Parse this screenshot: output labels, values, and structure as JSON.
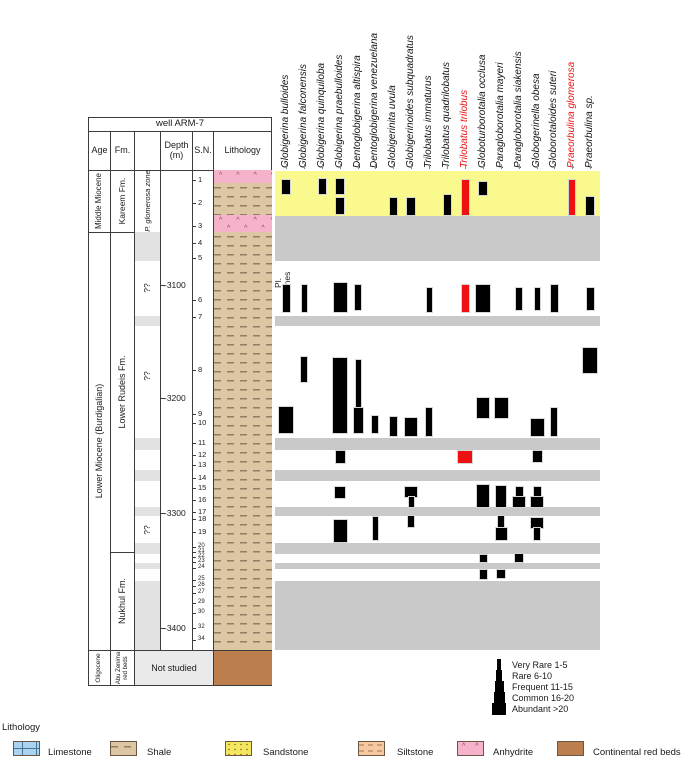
{
  "well_title": "well ARM-7",
  "columns": {
    "age": "Age",
    "fm": "Fm.",
    "zones": "Pl.\nzones",
    "depth": "Depth\n(m)",
    "sn": "S.N.",
    "lithology": "Lithology"
  },
  "ages": {
    "middle_miocene": "Middle Miocene",
    "lower_miocene": "Lower Miocene (Burdigalian)",
    "oligocene": "Oligocene"
  },
  "formations": {
    "kareem": "Kareem Fm.",
    "lower_rudeis": "Lower Rudeis Fm.",
    "nukhul": "Nukhul Fm.",
    "abu_zenima": "Abu Zenima red beds"
  },
  "zones": {
    "named_zone": "P. glomerosa zone",
    "unknown": "??",
    "unknown_y": [
      288,
      376,
      530
    ],
    "gray_blocks_y": [
      [
        232,
        261
      ],
      [
        316,
        326
      ],
      [
        438,
        450
      ],
      [
        470,
        481
      ],
      [
        507,
        516
      ],
      [
        543,
        554
      ],
      [
        563,
        569
      ],
      [
        581,
        650
      ]
    ]
  },
  "not_studied_label": "Not studied",
  "depth_ticks": [
    {
      "label": "-3100",
      "y": 285
    },
    {
      "label": "-3200",
      "y": 398
    },
    {
      "label": "-3300",
      "y": 513
    },
    {
      "label": "-3400",
      "y": 628
    }
  ],
  "samples": [
    {
      "n": 1,
      "y": 180
    },
    {
      "n": 2,
      "y": 203
    },
    {
      "n": 3,
      "y": 226
    },
    {
      "n": 4,
      "y": 243
    },
    {
      "n": 5,
      "y": 258
    },
    {
      "n": 6,
      "y": 300
    },
    {
      "n": 7,
      "y": 317
    },
    {
      "n": 8,
      "y": 370
    },
    {
      "n": 9,
      "y": 414
    },
    {
      "n": 10,
      "y": 423
    },
    {
      "n": 11,
      "y": 443
    },
    {
      "n": 12,
      "y": 455
    },
    {
      "n": 13,
      "y": 465
    },
    {
      "n": 14,
      "y": 478
    },
    {
      "n": 15,
      "y": 488
    },
    {
      "n": 16,
      "y": 500
    },
    {
      "n": 17,
      "y": 512
    },
    {
      "n": 18,
      "y": 519
    },
    {
      "n": 19,
      "y": 532
    },
    {
      "n": 20,
      "y": 547
    },
    {
      "n": 21,
      "y": 552
    },
    {
      "n": 22,
      "y": 557
    },
    {
      "n": 23,
      "y": 562
    },
    {
      "n": 24,
      "y": 568
    },
    {
      "n": 25,
      "y": 580
    },
    {
      "n": 26,
      "y": 586
    },
    {
      "n": 27,
      "y": 593
    },
    {
      "n": 29,
      "y": 603
    },
    {
      "n": 30,
      "y": 613
    },
    {
      "n": 32,
      "y": 628
    },
    {
      "n": 34,
      "y": 640
    }
  ],
  "chart_data": {
    "type": "bar",
    "subtype": "biostratigraphic-range-chart",
    "ylabel": "Depth (m)",
    "species": [
      {
        "name": "Globigerina bulloides",
        "red": false
      },
      {
        "name": "Globigerina falconensis",
        "red": false
      },
      {
        "name": "Globigerina quinquiloba",
        "red": false
      },
      {
        "name": "Globigerina praebulloides",
        "red": false
      },
      {
        "name": "Dentoglobigerina altispira",
        "red": false
      },
      {
        "name": "Dentoglobigerina venezuelana",
        "red": false
      },
      {
        "name": "Globigerinita uvula",
        "red": false
      },
      {
        "name": "Globigerinoides subquadratus",
        "red": false
      },
      {
        "name": "Trilobatus immaturus",
        "red": false
      },
      {
        "name": "Trilobatus quadrilobatus",
        "red": false
      },
      {
        "name": "Trilobatus trilobus",
        "red": true
      },
      {
        "name": "Globoturborotalia occlusa",
        "red": false
      },
      {
        "name": "Paragloborotalia mayeri",
        "red": false
      },
      {
        "name": "Paragloborotalia siakensis",
        "red": false
      },
      {
        "name": "Globogerinella obesa",
        "red": false
      },
      {
        "name": "Globorotaloides suteri",
        "red": false
      },
      {
        "name": "Praeorbulina glomerosa",
        "red": true
      },
      {
        "name": "Praeorbulina sp.",
        "red": false
      }
    ],
    "col_centers": [
      286,
      304,
      322,
      340,
      358,
      375,
      393,
      411,
      429,
      447,
      465,
      483,
      501,
      519,
      537,
      554,
      572,
      590
    ],
    "yellow_band_y": [
      171,
      216
    ],
    "gray_bands_y": [
      [
        216,
        261
      ],
      [
        316,
        326
      ],
      [
        438,
        450
      ],
      [
        470,
        481
      ],
      [
        507,
        516
      ],
      [
        543,
        554
      ],
      [
        563,
        569
      ],
      [
        581,
        650
      ]
    ],
    "bars": [
      {
        "s": 1,
        "y1": 180,
        "y2": 194,
        "w": 8,
        "c": "k"
      },
      {
        "s": 3,
        "y1": 179,
        "y2": 194,
        "w": 7,
        "c": "k"
      },
      {
        "s": 4,
        "y1": 179,
        "y2": 194,
        "w": 8,
        "c": "k"
      },
      {
        "s": 4,
        "y1": 198,
        "y2": 214,
        "w": 8,
        "c": "k"
      },
      {
        "s": 7,
        "y1": 198,
        "y2": 215,
        "w": 7,
        "c": "k"
      },
      {
        "s": 8,
        "y1": 198,
        "y2": 215,
        "w": 8,
        "c": "k"
      },
      {
        "s": 10,
        "y1": 195,
        "y2": 215,
        "w": 7,
        "c": "k"
      },
      {
        "s": 11,
        "y1": 180,
        "y2": 215,
        "w": 7,
        "c": "r"
      },
      {
        "s": 12,
        "y1": 182,
        "y2": 195,
        "w": 8,
        "c": "k"
      },
      {
        "s": 17,
        "y1": 180,
        "y2": 215,
        "w": 6,
        "c": "r"
      },
      {
        "s": 18,
        "y1": 197,
        "y2": 215,
        "w": 8,
        "c": "k"
      },
      {
        "s": 1,
        "y1": 285,
        "y2": 312,
        "w": 7,
        "c": "k"
      },
      {
        "s": 2,
        "y1": 285,
        "y2": 312,
        "w": 5,
        "c": "k"
      },
      {
        "s": 4,
        "y1": 283,
        "y2": 312,
        "w": 13,
        "c": "k"
      },
      {
        "s": 5,
        "y1": 285,
        "y2": 310,
        "w": 6,
        "c": "k"
      },
      {
        "s": 9,
        "y1": 288,
        "y2": 312,
        "w": 5,
        "c": "k"
      },
      {
        "s": 11,
        "y1": 285,
        "y2": 312,
        "w": 7,
        "c": "r"
      },
      {
        "s": 12,
        "y1": 285,
        "y2": 312,
        "w": 14,
        "c": "k"
      },
      {
        "s": 14,
        "y1": 288,
        "y2": 310,
        "w": 6,
        "c": "k"
      },
      {
        "s": 15,
        "y1": 288,
        "y2": 310,
        "w": 5,
        "c": "k"
      },
      {
        "s": 16,
        "y1": 285,
        "y2": 312,
        "w": 7,
        "c": "k"
      },
      {
        "s": 18,
        "y1": 288,
        "y2": 310,
        "w": 7,
        "c": "k"
      },
      {
        "s": 1,
        "y1": 407,
        "y2": 433,
        "w": 14,
        "c": "k"
      },
      {
        "s": 2,
        "y1": 357,
        "y2": 382,
        "w": 6,
        "c": "k"
      },
      {
        "s": 4,
        "y1": 358,
        "y2": 433,
        "w": 14,
        "c": "k"
      },
      {
        "s": 5,
        "y1": 360,
        "y2": 408,
        "w": 5,
        "c": "k"
      },
      {
        "s": 5,
        "y1": 408,
        "y2": 433,
        "w": 9,
        "c": "k"
      },
      {
        "s": 6,
        "y1": 416,
        "y2": 433,
        "w": 6,
        "c": "k"
      },
      {
        "s": 7,
        "y1": 417,
        "y2": 436,
        "w": 7,
        "c": "k"
      },
      {
        "s": 8,
        "y1": 418,
        "y2": 436,
        "w": 12,
        "c": "k"
      },
      {
        "s": 9,
        "y1": 408,
        "y2": 436,
        "w": 6,
        "c": "k"
      },
      {
        "s": 12,
        "y1": 398,
        "y2": 418,
        "w": 12,
        "c": "k"
      },
      {
        "s": 13,
        "y1": 398,
        "y2": 418,
        "w": 13,
        "c": "k"
      },
      {
        "s": 15,
        "y1": 419,
        "y2": 436,
        "w": 13,
        "c": "k"
      },
      {
        "s": 16,
        "y1": 408,
        "y2": 436,
        "w": 6,
        "c": "k"
      },
      {
        "s": 18,
        "y1": 348,
        "y2": 373,
        "w": 14,
        "c": "k"
      },
      {
        "s": 4,
        "y1": 451,
        "y2": 463,
        "w": 9,
        "c": "k"
      },
      {
        "s": 11,
        "y1": 451,
        "y2": 463,
        "w": 14,
        "c": "r"
      },
      {
        "s": 15,
        "y1": 451,
        "y2": 462,
        "w": 9,
        "c": "k"
      },
      {
        "s": 4,
        "y1": 487,
        "y2": 498,
        "w": 10,
        "c": "k"
      },
      {
        "s": 8,
        "y1": 487,
        "y2": 497,
        "w": 12,
        "c": "k"
      },
      {
        "s": 8,
        "y1": 497,
        "y2": 507,
        "w": 5,
        "c": "k"
      },
      {
        "s": 12,
        "y1": 485,
        "y2": 507,
        "w": 12,
        "c": "k"
      },
      {
        "s": 13,
        "y1": 486,
        "y2": 507,
        "w": 10,
        "c": "k"
      },
      {
        "s": 14,
        "y1": 487,
        "y2": 497,
        "w": 7,
        "c": "k"
      },
      {
        "s": 14,
        "y1": 497,
        "y2": 507,
        "w": 12,
        "c": "k"
      },
      {
        "s": 15,
        "y1": 487,
        "y2": 497,
        "w": 7,
        "c": "k"
      },
      {
        "s": 15,
        "y1": 497,
        "y2": 507,
        "w": 12,
        "c": "k"
      },
      {
        "s": 4,
        "y1": 520,
        "y2": 542,
        "w": 13,
        "c": "k"
      },
      {
        "s": 6,
        "y1": 517,
        "y2": 540,
        "w": 5,
        "c": "k"
      },
      {
        "s": 8,
        "y1": 516,
        "y2": 527,
        "w": 6,
        "c": "k"
      },
      {
        "s": 13,
        "y1": 516,
        "y2": 528,
        "w": 6,
        "c": "k"
      },
      {
        "s": 13,
        "y1": 528,
        "y2": 540,
        "w": 11,
        "c": "k"
      },
      {
        "s": 15,
        "y1": 518,
        "y2": 528,
        "w": 12,
        "c": "k"
      },
      {
        "s": 15,
        "y1": 528,
        "y2": 540,
        "w": 6,
        "c": "k"
      },
      {
        "s": 12,
        "y1": 555,
        "y2": 562,
        "w": 7,
        "c": "k"
      },
      {
        "s": 14,
        "y1": 554,
        "y2": 562,
        "w": 8,
        "c": "k"
      },
      {
        "s": 12,
        "y1": 570,
        "y2": 579,
        "w": 7,
        "c": "k"
      },
      {
        "s": 13,
        "y1": 570,
        "y2": 578,
        "w": 8,
        "c": "k"
      }
    ]
  },
  "abundance_legend": [
    {
      "label": "Very Rare 1-5",
      "w": 4
    },
    {
      "label": "Rare 6-10",
      "w": 6
    },
    {
      "label": "Frequent 11-15",
      "w": 9
    },
    {
      "label": "Common 16-20",
      "w": 11
    },
    {
      "label": "Abundant >20",
      "w": 14
    }
  ],
  "lithology_legend": {
    "title": "Lithology",
    "items": [
      {
        "label": "Limestone"
      },
      {
        "label": "Shale"
      },
      {
        "label": "Sandstone"
      },
      {
        "label": "Siltstone"
      },
      {
        "label": "Anhydrite"
      },
      {
        "label": "Continental red beds"
      }
    ]
  },
  "colors": {
    "bar_black": "#000000",
    "bar_red": "#ee1111",
    "band_yellow": "#f9f98e",
    "band_gray": "#c9c9c9",
    "zone_gray": "#e2e2e2",
    "not_studied_gray": "#eaeaea",
    "shale": "#dcc6a4",
    "anhydrite": "#f4b3ca",
    "red_beds": "#bd7e4d",
    "limestone": "#a9d3ee",
    "sandstone": "#f4e760",
    "siltstone": "#f6c9a0"
  }
}
